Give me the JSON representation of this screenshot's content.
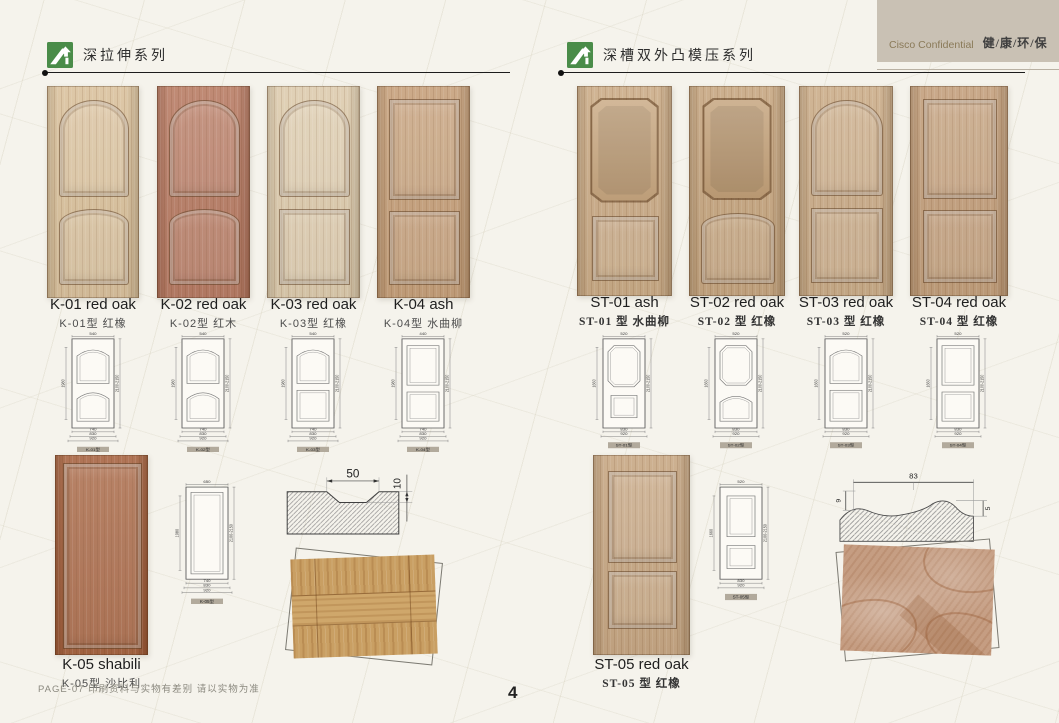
{
  "header": {
    "confidential": "Cisco Confidential",
    "slogan": "健/康/环/保",
    "logo_color": "#4a8c49",
    "banner_color": "#c9c1b4"
  },
  "footer": {
    "note": "PAGE-07  印刷资料与实物有差别   请以实物为准",
    "page_number": "4"
  },
  "sections": [
    {
      "title": "深拉伸系列",
      "doors": [
        {
          "code": "K-01",
          "name_en": "K-01 red oak",
          "name_cn": "K-01型 红橡",
          "caption": "K-01型",
          "type": "arch-arch",
          "base": "#d7bd96",
          "top_dim": "540"
        },
        {
          "code": "K-02",
          "name_en": "K-02 red oak",
          "name_cn": "K-02型 红木",
          "caption": "K-02型",
          "type": "arch-arch",
          "base": "#b3735a",
          "top_dim": "540"
        },
        {
          "code": "K-03",
          "name_en": "K-03 red oak",
          "name_cn": "K-03型 红橡",
          "caption": "K-03型",
          "type": "arch-rect",
          "base": "#dbc8a8",
          "top_dim": "540"
        },
        {
          "code": "K-04",
          "name_en": "K-04 ash",
          "name_cn": "K-04型 水曲柳",
          "caption": "K-04型",
          "type": "rect-rect",
          "base": "#c29a72",
          "top_dim": "440"
        },
        {
          "code": "K-05",
          "name_en": "K-05 shabili",
          "name_cn": "K-05型 沙比利",
          "caption": "K-05型",
          "type": "single-rect",
          "base": "#a15a35",
          "top_dim": "650"
        }
      ],
      "dims": {
        "side_left": "1980",
        "side_right": "2100-2150",
        "bottoms": [
          "740",
          "830",
          "920"
        ]
      },
      "profile": {
        "top": "50",
        "right": "10"
      }
    },
    {
      "title": "深槽双外凸模压系列",
      "doors": [
        {
          "code": "ST-01",
          "name_en": "ST-01 ash",
          "name_cn": "ST-01 型 水曲柳",
          "caption": "ST-01型",
          "type": "hex-rect",
          "base": "#c7a67f",
          "top_dim": "520"
        },
        {
          "code": "ST-02",
          "name_en": "ST-02 red oak",
          "name_cn": "ST-02 型 红橡",
          "caption": "ST-02型",
          "type": "hex-arch",
          "base": "#c2a078",
          "top_dim": "520"
        },
        {
          "code": "ST-03",
          "name_en": "ST-03 red oak",
          "name_cn": "ST-03 型 红橡",
          "caption": "ST-03型",
          "type": "arch-rect",
          "base": "#c7a781",
          "top_dim": "520"
        },
        {
          "code": "ST-04",
          "name_en": "ST-04 red oak",
          "name_cn": "ST-04 型 红橡",
          "caption": "ST-04型",
          "type": "rect-rect",
          "base": "#bf9973",
          "top_dim": "520"
        },
        {
          "code": "ST-05",
          "name_en": "ST-05 red oak",
          "name_cn": "ST-05 型 红橡",
          "caption": "ST-05型",
          "type": "rect-rect-b",
          "base": "#c3a17b",
          "top_dim": "520"
        }
      ],
      "dims": {
        "side_left": "1660",
        "side_right": "2100-2150",
        "bottoms": [
          "830",
          "920"
        ]
      },
      "profile": {
        "top": "83",
        "left": "9",
        "right": "5"
      }
    }
  ]
}
